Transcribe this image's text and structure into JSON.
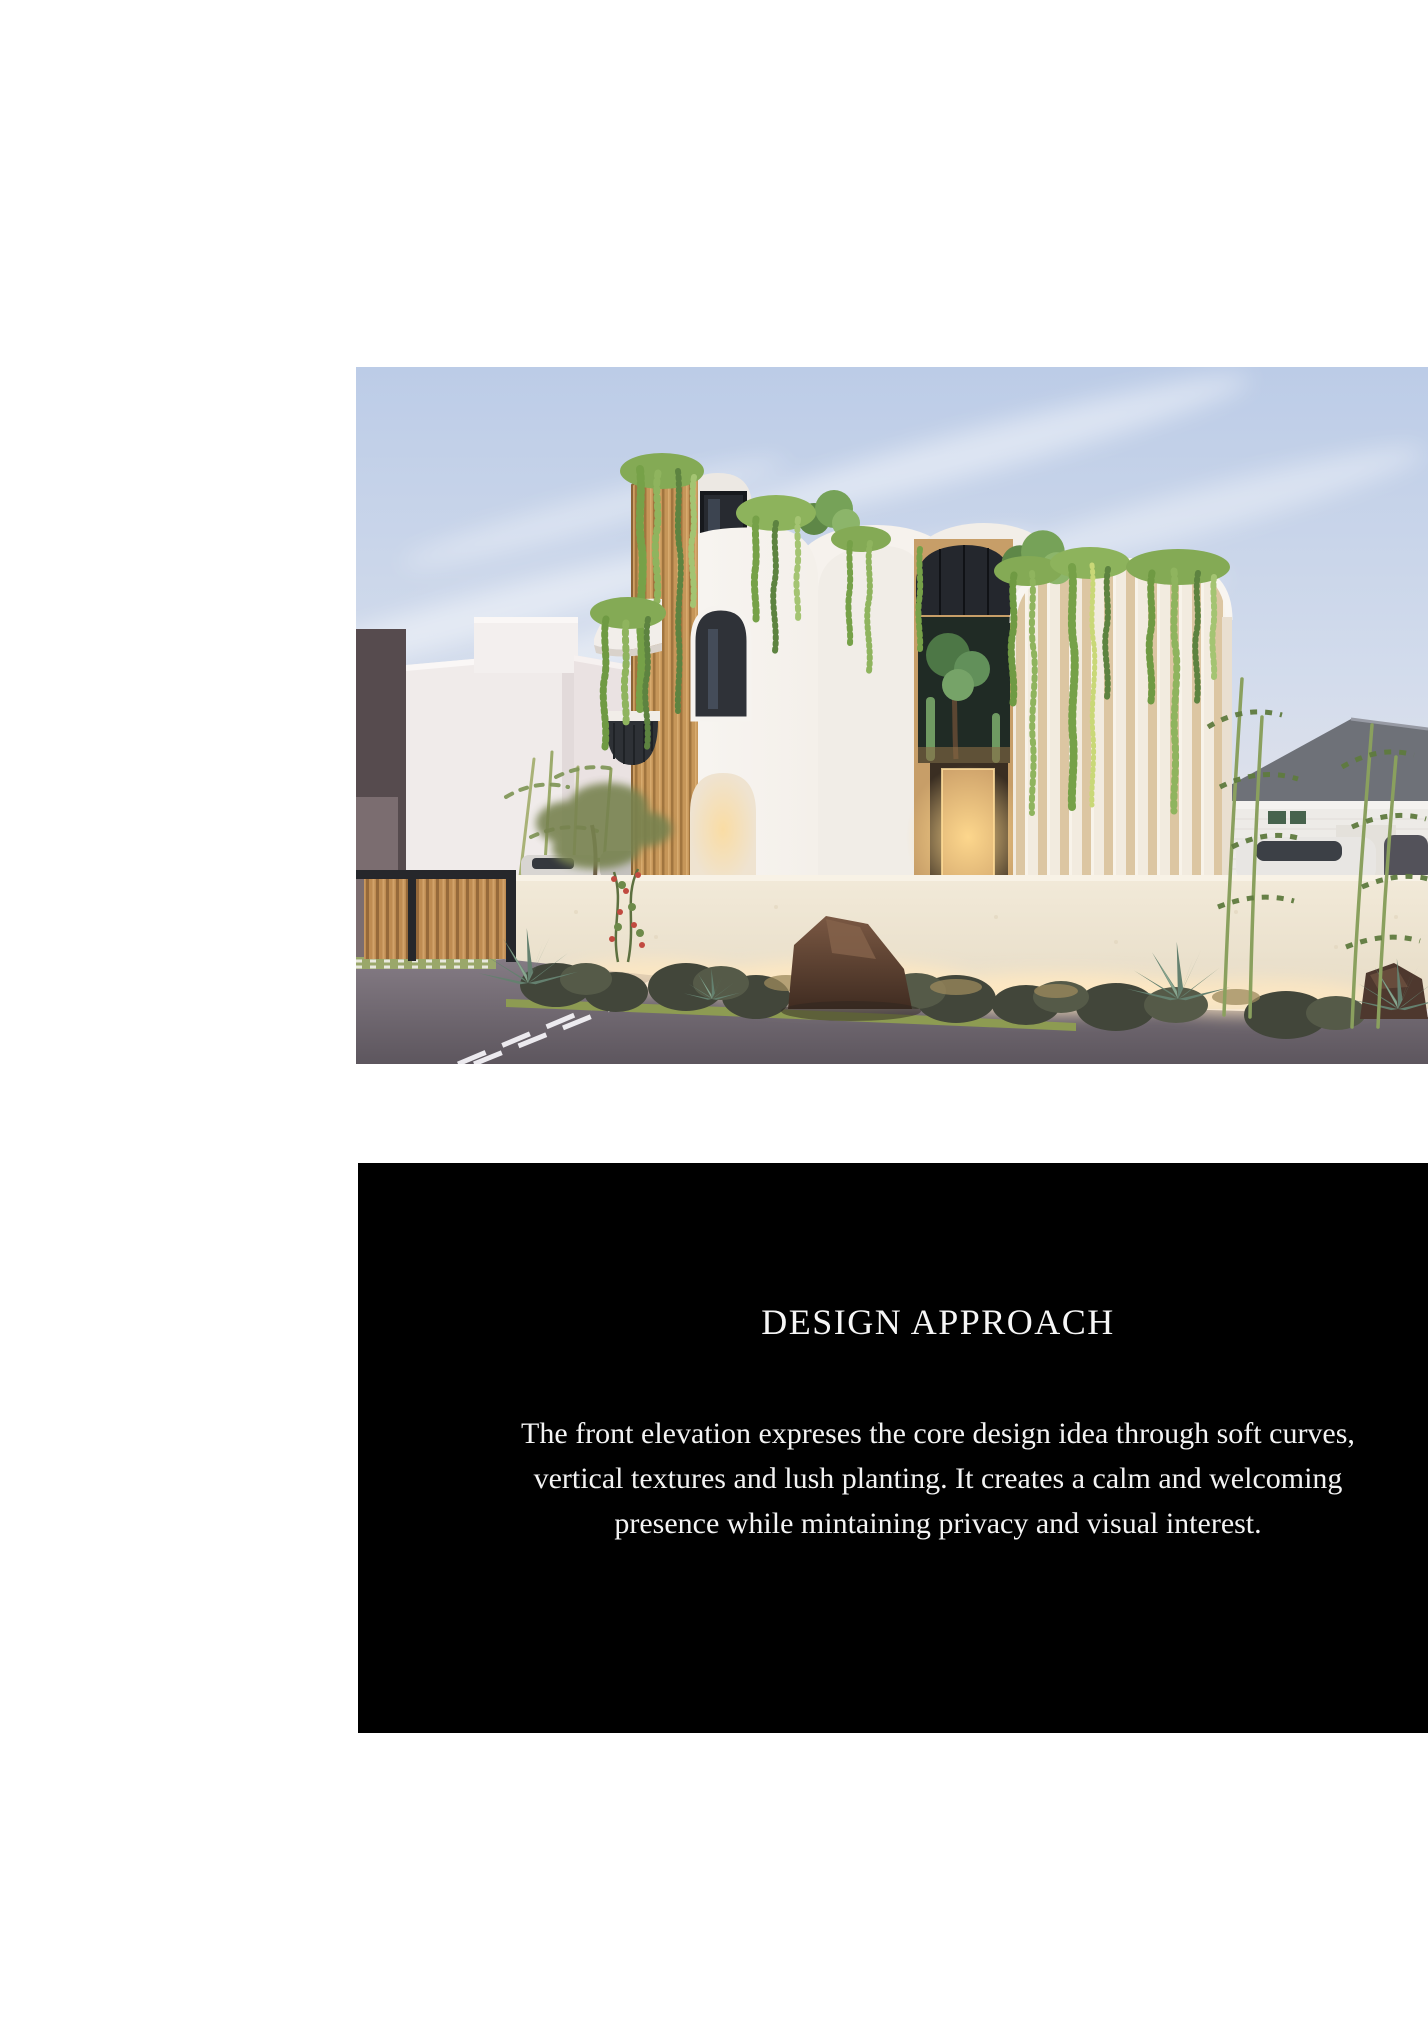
{
  "design_section": {
    "title": "DESIGN APPROACH",
    "paragraph_lines": [
      "The front elevation expreses the core design idea through soft curves,",
      "vertical textures and lush planting. It creates a calm and welcoming",
      "presence while mintaining privacy and visual interest."
    ],
    "panel_background": "#000000",
    "text_color": "#fdfdfd"
  },
  "hero_render": {
    "palette": {
      "sky_blue": "#c3d1e8",
      "stucco_white": "#f6f3ef",
      "wood_tan": "#c69659",
      "foliage_green": "#7fa94e",
      "road_gray": "#6e666e",
      "warm_glow": "#ffe3ae"
    }
  }
}
